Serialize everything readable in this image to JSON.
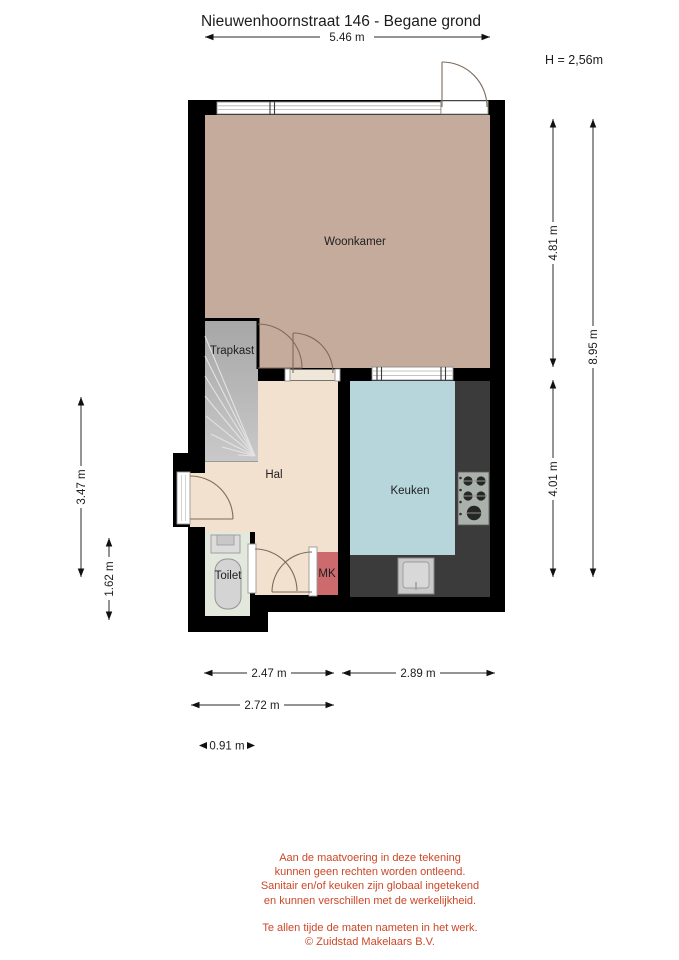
{
  "title": "Nieuwenhoornstraat 146 - Begane grond",
  "ceiling_height_label": "H = 2,56m",
  "rooms": {
    "woonkamer": "Woonkamer",
    "trapkast": "Trapkast",
    "hal": "Hal",
    "keuken": "Keuken",
    "toilet": "Toilet",
    "mk": "MK"
  },
  "dimensions": {
    "top_width": "5.46 m",
    "right_upper": "4.81 m",
    "right_lower": "4.01 m",
    "right_total": "8.95 m",
    "left_hall": "3.47 m",
    "left_toilet": "1.62 m",
    "bottom_hall_width": "2.47 m",
    "bottom_kitchen_width": "2.89 m",
    "bottom_outer_width": "2.72 m",
    "bottom_entry_width": "0.91 m"
  },
  "disclaimer": {
    "lines": [
      "Aan de maatvoering in deze tekening",
      "kunnen geen rechten worden ontleend.",
      "Sanitair en/of keuken zijn globaal ingetekend",
      "en kunnen verschillen met de werkelijkheid.",
      "Te allen tijde de maten nameten in het werk."
    ],
    "copyright": "© Zuidstad Makelaars B.V."
  },
  "colors": {
    "wall": "#000000",
    "woonkamer": "#c5ab9b",
    "hal": "#f2e1cf",
    "keuken": "#b6d6dc",
    "toilet": "#e2e9dc",
    "trapkast": "#b4b4b4",
    "mk": "#cd6a6e",
    "counter": "#3b3b3b",
    "disclaimer_text": "#cc4727"
  }
}
